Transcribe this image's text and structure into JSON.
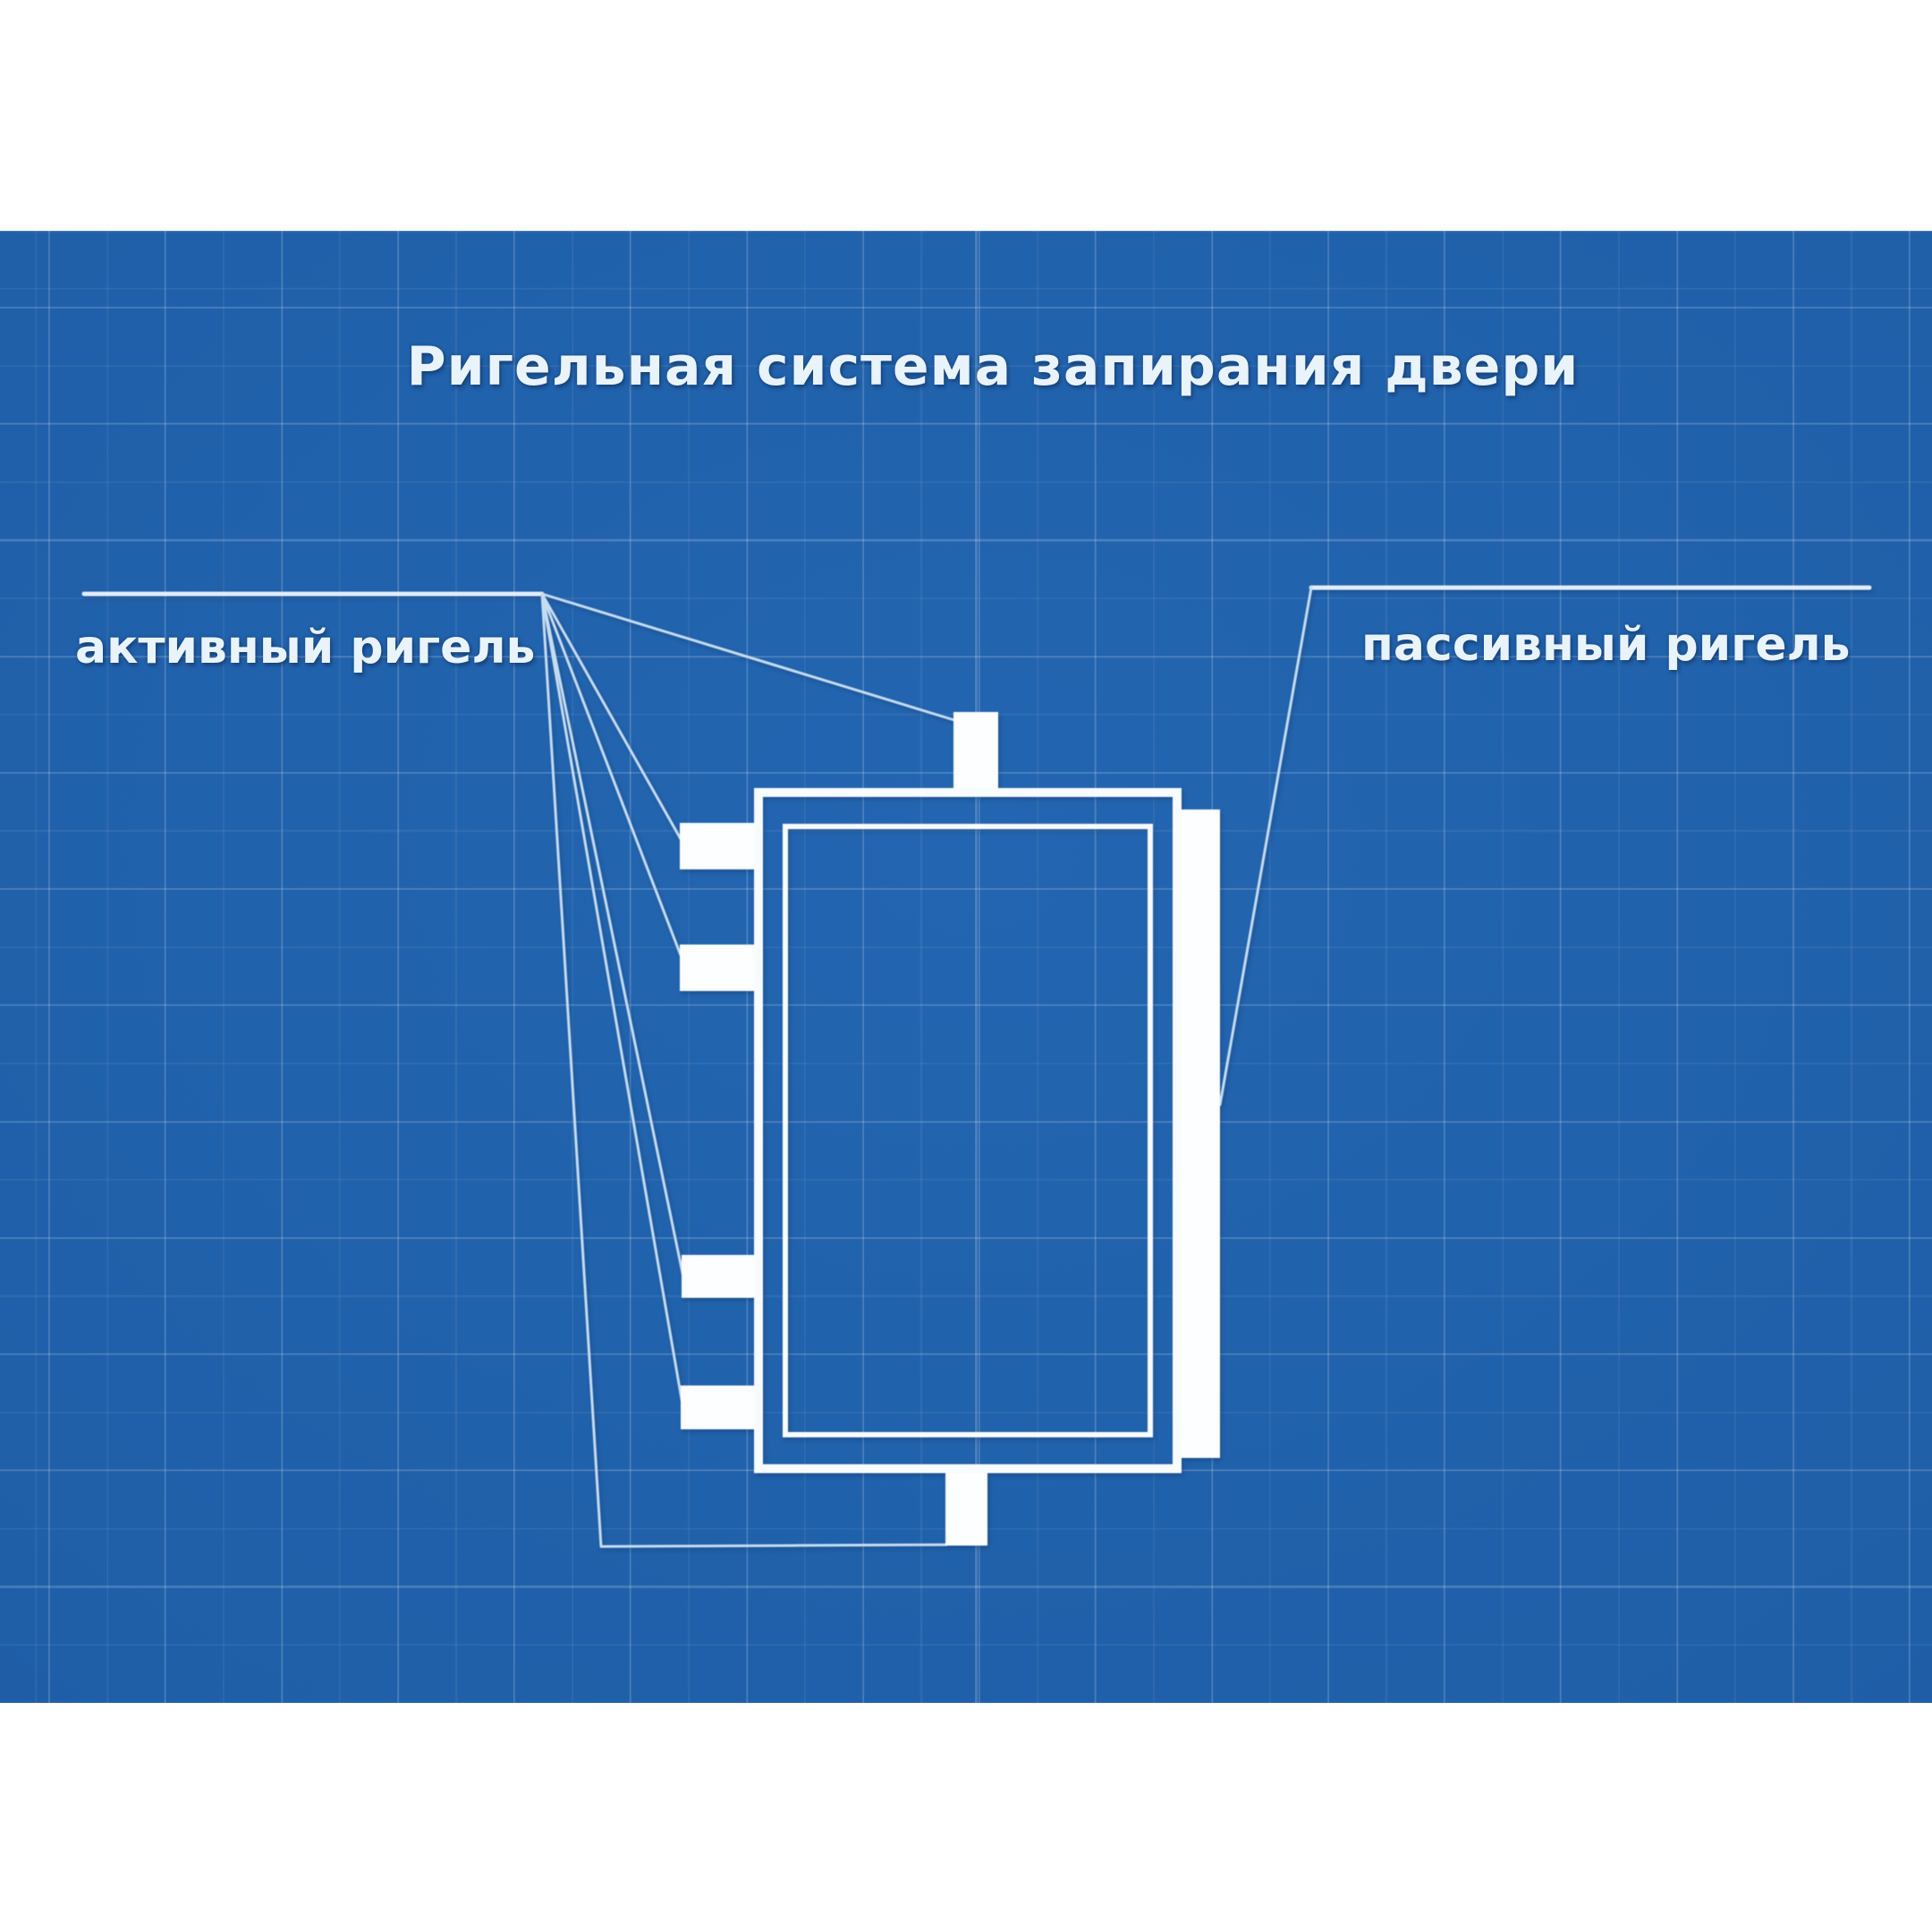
{
  "title": "Ригельная система запирания двери",
  "labels": {
    "active_bolt": "активный ригель",
    "passive_bolt": "пассивный ригель"
  },
  "theme": {
    "page_bg": "#ffffff",
    "blueprint_blue": "#1f5fa8",
    "blueprint_blue_light": "#2365b0",
    "blueprint_blue_dark": "#1a5098",
    "drawing_white": "#f8fbff",
    "bolt_fill": "#fdfeff",
    "leader_line": "#c6dcf2",
    "label_line": "#e2edf9",
    "text_color": "#e9f3fc"
  }
}
